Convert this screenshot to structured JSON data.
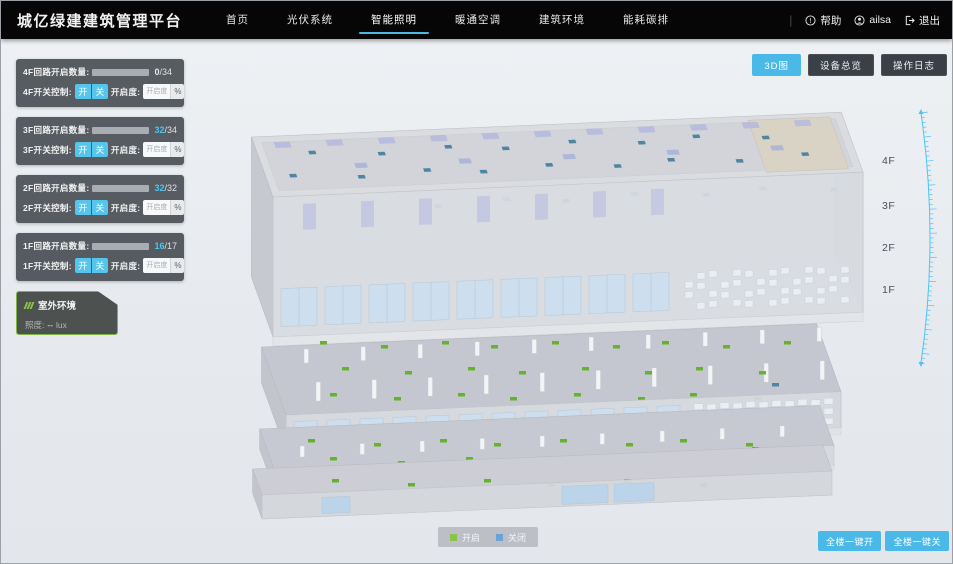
{
  "header": {
    "title": "城亿绿建建筑管理平台",
    "nav": [
      {
        "label": "首页",
        "active": false
      },
      {
        "label": "光伏系统",
        "active": false
      },
      {
        "label": "智能照明",
        "active": true
      },
      {
        "label": "暖通空调",
        "active": false
      },
      {
        "label": "建筑环境",
        "active": false
      },
      {
        "label": "能耗碳排",
        "active": false
      }
    ],
    "help_label": "帮助",
    "username": "ailsa",
    "logout_label": "退出"
  },
  "toolbar": {
    "buttons": [
      {
        "label": "3D图",
        "active": true
      },
      {
        "label": "设备总览",
        "active": false
      },
      {
        "label": "操作日志",
        "active": false
      }
    ]
  },
  "floor_panels": [
    {
      "floor": "4F",
      "count_label": "4F回路开启数量:",
      "num": "0",
      "den": "/34",
      "open": 0,
      "total": 34,
      "control_label": "4F开关控制:",
      "on_label": "开",
      "off_label": "关",
      "openness_label": "开启度:",
      "openness_placeholder": "开启度",
      "percent_label": "%"
    },
    {
      "floor": "3F",
      "count_label": "3F回路开启数量:",
      "num": "32",
      "den": "/34",
      "open": 32,
      "total": 34,
      "control_label": "3F开关控制:",
      "on_label": "开",
      "off_label": "关",
      "openness_label": "开启度:",
      "openness_placeholder": "开启度",
      "percent_label": "%"
    },
    {
      "floor": "2F",
      "count_label": "2F回路开启数量:",
      "num": "32",
      "den": "/32",
      "open": 32,
      "total": 32,
      "control_label": "2F开关控制:",
      "on_label": "开",
      "off_label": "关",
      "openness_label": "开启度:",
      "openness_placeholder": "开启度",
      "percent_label": "%"
    },
    {
      "floor": "1F",
      "count_label": "1F回路开启数量:",
      "num": "16",
      "den": "/17",
      "open": 16,
      "total": 17,
      "control_label": "1F开关控制:",
      "on_label": "开",
      "off_label": "关",
      "openness_label": "开启度:",
      "openness_placeholder": "开启度",
      "percent_label": "%"
    }
  ],
  "outdoor_panel": {
    "title": "室外环境",
    "metric_label": "照度:",
    "value": "--",
    "unit": "lux"
  },
  "floor_axis_labels": [
    "4F",
    "3F",
    "2F",
    "1F"
  ],
  "legend": {
    "items": [
      {
        "label": "开启",
        "color": "#8bc34a"
      },
      {
        "label": "关闭",
        "color": "#6aa3d8"
      }
    ]
  },
  "footer_buttons": [
    {
      "label": "全楼一键开"
    },
    {
      "label": "全楼一键关"
    }
  ],
  "colors": {
    "accent": "#4bb9e7",
    "light_on": "#63b32e",
    "light_off": "#4e86a2",
    "ruler": "#4fc3f7"
  }
}
